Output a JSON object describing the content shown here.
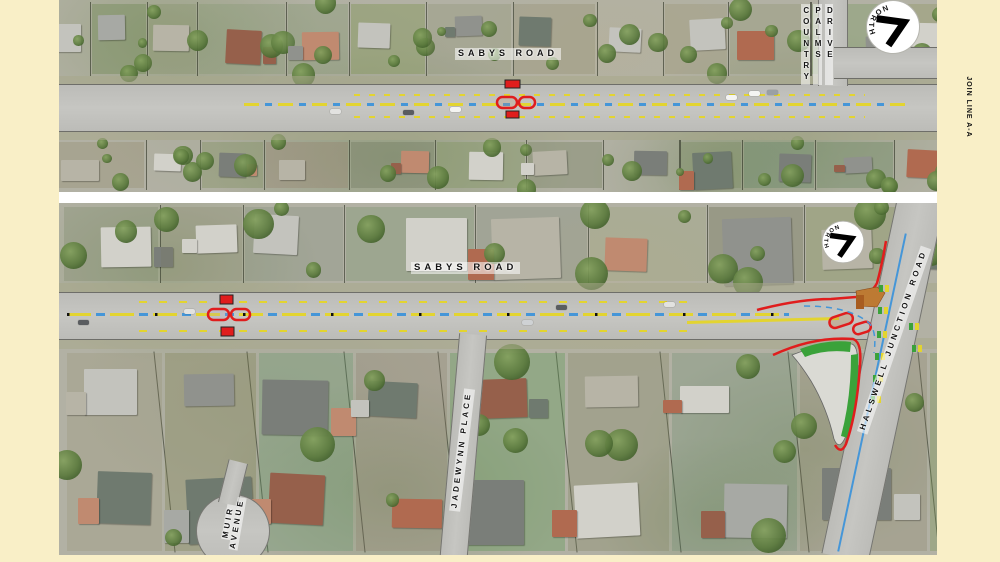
{
  "colors": {
    "page_bg": "#f9efc7",
    "gap": "#ffffff",
    "aerial_base": "#b2b1a4",
    "road": "#bcbcb8",
    "red": "#e01d1d",
    "yellow": "#e3d430",
    "blue": "#4596d8",
    "green": "#3aa23a",
    "tan": "#bd7a33",
    "island": "#dadad4",
    "label": "#141414"
  },
  "join_line_label": "JOIN LINE A-A",
  "top_panel": {
    "road_label": "SABYS ROAD",
    "cross_street_lines": [
      "COUNTRY",
      "PALMS",
      "DRIVE"
    ],
    "north_label": "NORTH"
  },
  "bottom_panel": {
    "road_label": "SABYS ROAD",
    "side_street_label": "JADEWYNN PLACE",
    "cul_de_sac_lines": [
      "MUIR",
      "AVENUE"
    ],
    "main_road_label": "HALSWELL JUNCTION ROAD",
    "north_label": "NORTH"
  }
}
